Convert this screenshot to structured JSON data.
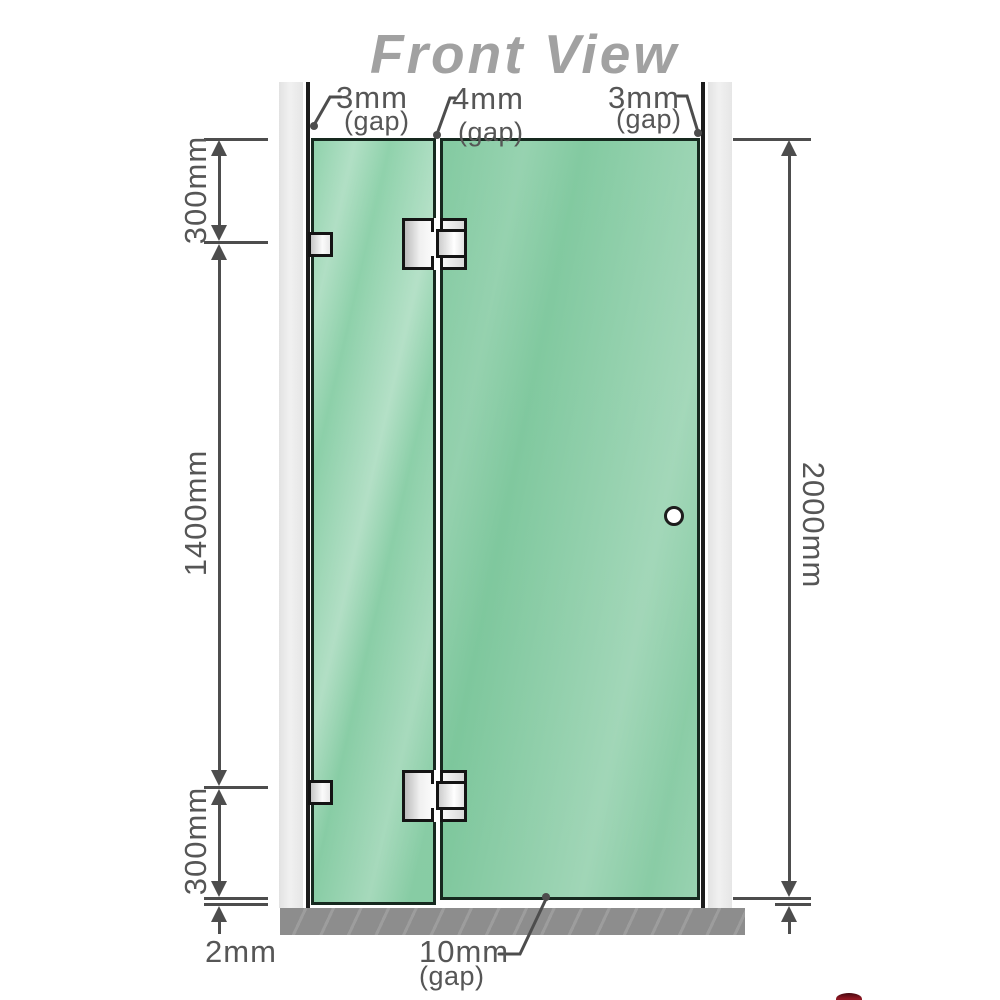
{
  "title": "Front View",
  "gap_labels": {
    "left": {
      "value": "3mm",
      "qualifier": "(gap)"
    },
    "middle": {
      "value": "4mm",
      "qualifier": "(gap)"
    },
    "right": {
      "value": "3mm",
      "qualifier": "(gap)"
    },
    "bottom": {
      "value": "10mm",
      "qualifier": "(gap)"
    }
  },
  "dimensions": {
    "left_top": "300mm",
    "left_middle": "1400mm",
    "left_bottom": "300mm",
    "right": "2000mm",
    "floor_gap": "2mm"
  },
  "colors": {
    "glass": "#87cca4",
    "glass_highlight": "#b2e1c7",
    "glass_outline": "#16291f",
    "wall_channel": "#eaeaea",
    "wall_edge_line": "#1c1c1c",
    "hardware_silver": "#f0f0f0",
    "hardware_outline": "#141414",
    "floor": "#8d8d8d",
    "dimension_line": "#4d4d4d",
    "label_text": "#565656",
    "title_text": "#a1a1a1",
    "watermark_fragment": "#8e1722"
  }
}
